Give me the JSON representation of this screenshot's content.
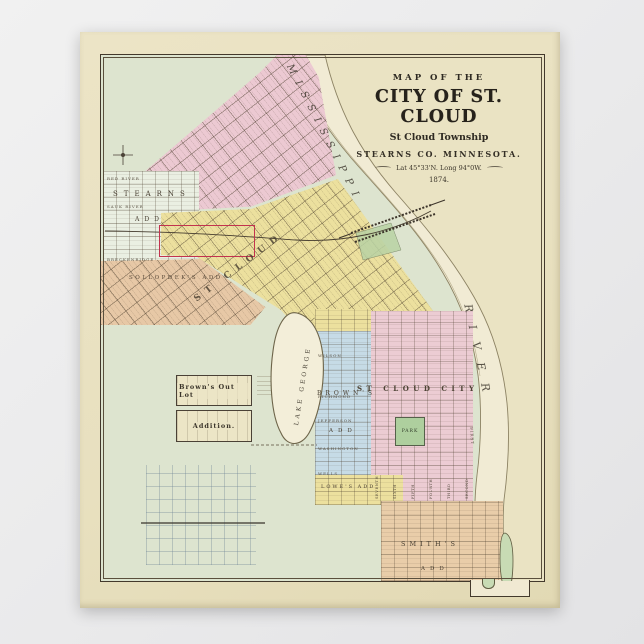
{
  "title_block": {
    "line1": "MAP OF THE",
    "line2": "CITY OF ST. CLOUD",
    "line3": "St Cloud Township",
    "line4": "STEARNS CO. MINNESOTA.",
    "line5": "Lat 45°33'N. Long 94°0W.",
    "line6": "1874."
  },
  "map": {
    "river": {
      "upper": "MISSISSIPPI",
      "lower": "RIVER"
    },
    "lake": "LAKE GEORGE",
    "park": "PARK",
    "plats": {
      "stearns_line1": "STEARNS",
      "stearns_line2": "ADD",
      "sollopdek": "SOLLOPDEK'S  ADD",
      "st_cloud": "ST  CLOUD",
      "browns_line1": "BROWN'S",
      "browns_line2": "ADD",
      "st_cloud_city": "ST CLOUD CITY",
      "smiths_line1": "SMITH'S",
      "smiths_line2": "ADD",
      "lowes": "LOWE'S ADD",
      "outlot_line1": "Brown's Out Lot",
      "outlot_line2": "Addition."
    },
    "streets": {
      "red_river": "RED RIVER",
      "sauk_river": "SAUK RIVER",
      "breckenridge": "BRECKENRIDGE",
      "wilson": "WILSON",
      "richmond": "RICHMOND",
      "jefferson": "JEFFERSON",
      "washington": "WASHINGTON",
      "wells": "WELLS",
      "first": "FIRST",
      "numbered": [
        "SEVENTH",
        "SIXTH",
        "FIFTH",
        "FOURTH",
        "THIRD",
        "SECOND"
      ]
    }
  }
}
